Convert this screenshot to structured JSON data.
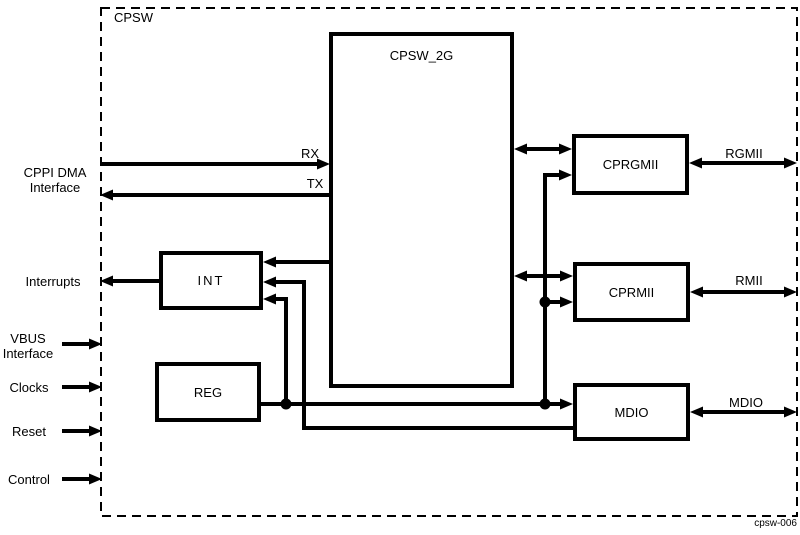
{
  "diagram": {
    "title": "CPSW",
    "watermark": "cpsw-006",
    "colors": {
      "ink": "#000000",
      "background": "#ffffff"
    },
    "blocks": {
      "cpsw2g": "CPSW_2G",
      "int": "INT",
      "reg": "REG",
      "cprgmii": "CPRGMII",
      "cprmii": "CPRMII",
      "mdio": "MDIO"
    },
    "left_labels": {
      "cppi_dma": "CPPI DMA\nInterface",
      "interrupts": "Interrupts",
      "vbus": "VBUS\nInterface",
      "clocks": "Clocks",
      "reset": "Reset",
      "control": "Control"
    },
    "edge_labels": {
      "rx": "RX",
      "tx": "TX",
      "rgmii": "RGMII",
      "rmii": "RMII",
      "mdio": "MDIO"
    }
  }
}
